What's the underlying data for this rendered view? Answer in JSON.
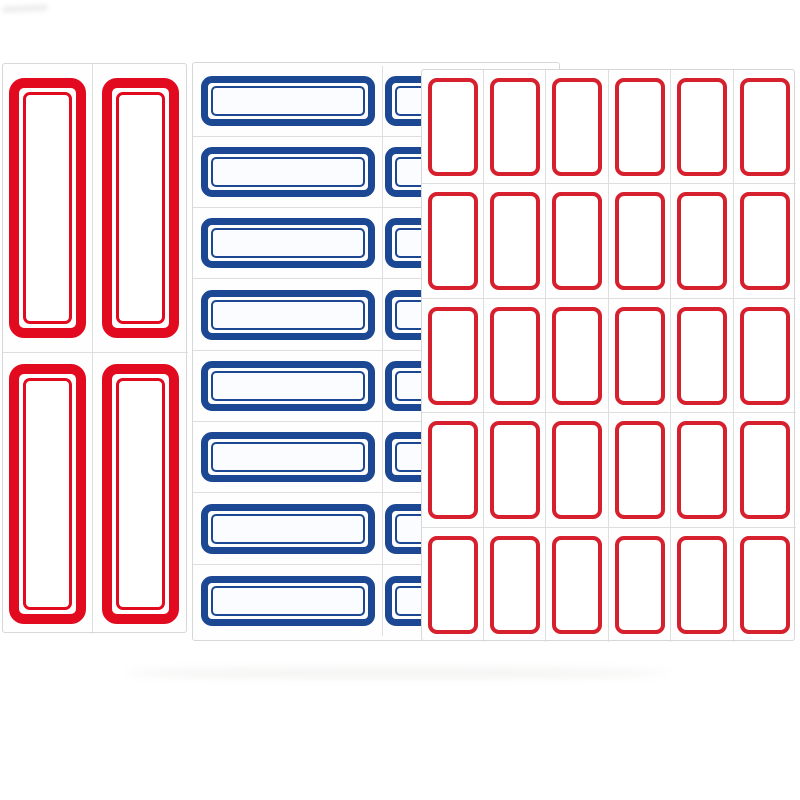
{
  "scene": {
    "description": "Three blank self-adhesive label sticker sheets on a white background",
    "background_color": "#ffffff",
    "sheet_background": "#fefefe",
    "sheet_border_color": "#d5d7d9",
    "grid_line_color": "#dcdee0"
  },
  "sheets": [
    {
      "name": "sheet-red-tall-labels",
      "description": "Sheet of 4 tall blank labels with thick red double borders, 2 columns x 2 rows",
      "x": 2,
      "y": 63,
      "width": 185,
      "height": 570,
      "z": 1,
      "grid": {
        "rows": 2,
        "cols": 2,
        "col_widths": [
          90,
          95
        ],
        "row_heights": [
          289,
          281
        ],
        "top": 0,
        "left": 0
      },
      "label": {
        "type": "double",
        "width": 77,
        "height": 260,
        "border_width": 10,
        "border_radius": 15,
        "gap": 4,
        "inner_border_width": 3,
        "inner_border_radius": 7,
        "color": "#e20a1f",
        "fill": "#ffffff"
      },
      "labels_total": 4
    },
    {
      "name": "sheet-blue-strip-labels",
      "description": "Sheet of horizontal blank strip labels with blue double borders, 8 rows x 2 columns, right column hidden behind the red sheet",
      "x": 192,
      "y": 62,
      "width": 368,
      "height": 579,
      "z": 2,
      "grid": {
        "rows": 8,
        "cols": 2,
        "col_widths": [
          190,
          178
        ],
        "row_heights": [
          71,
          71,
          71,
          72,
          71,
          71,
          72,
          71
        ],
        "top": 3,
        "left": 0
      },
      "label": {
        "type": "double",
        "width": 174,
        "height": 50,
        "border_width": 7,
        "border_radius": 11,
        "gap": 3,
        "inner_border_width": 2,
        "inner_border_radius": 5,
        "color": "#1c4793",
        "fill": "#fafcff"
      },
      "labels_total": 16
    },
    {
      "name": "sheet-red-small-labels",
      "description": "Sheet of 30 small blank labels with single red borders, 6 columns x 5 rows",
      "x": 421,
      "y": 69,
      "width": 374,
      "height": 572,
      "z": 3,
      "grid": {
        "rows": 5,
        "cols": 6,
        "col_widths": [
          62,
          62,
          63,
          62,
          63,
          62
        ],
        "row_heights": [
          114,
          115,
          114,
          115,
          114
        ],
        "top": 0,
        "left": 0
      },
      "label": {
        "type": "single",
        "width": 50,
        "height": 98,
        "border_width": 4,
        "border_radius": 9,
        "color": "#d7202e",
        "fill": "#ffffff"
      },
      "labels_total": 30
    }
  ]
}
